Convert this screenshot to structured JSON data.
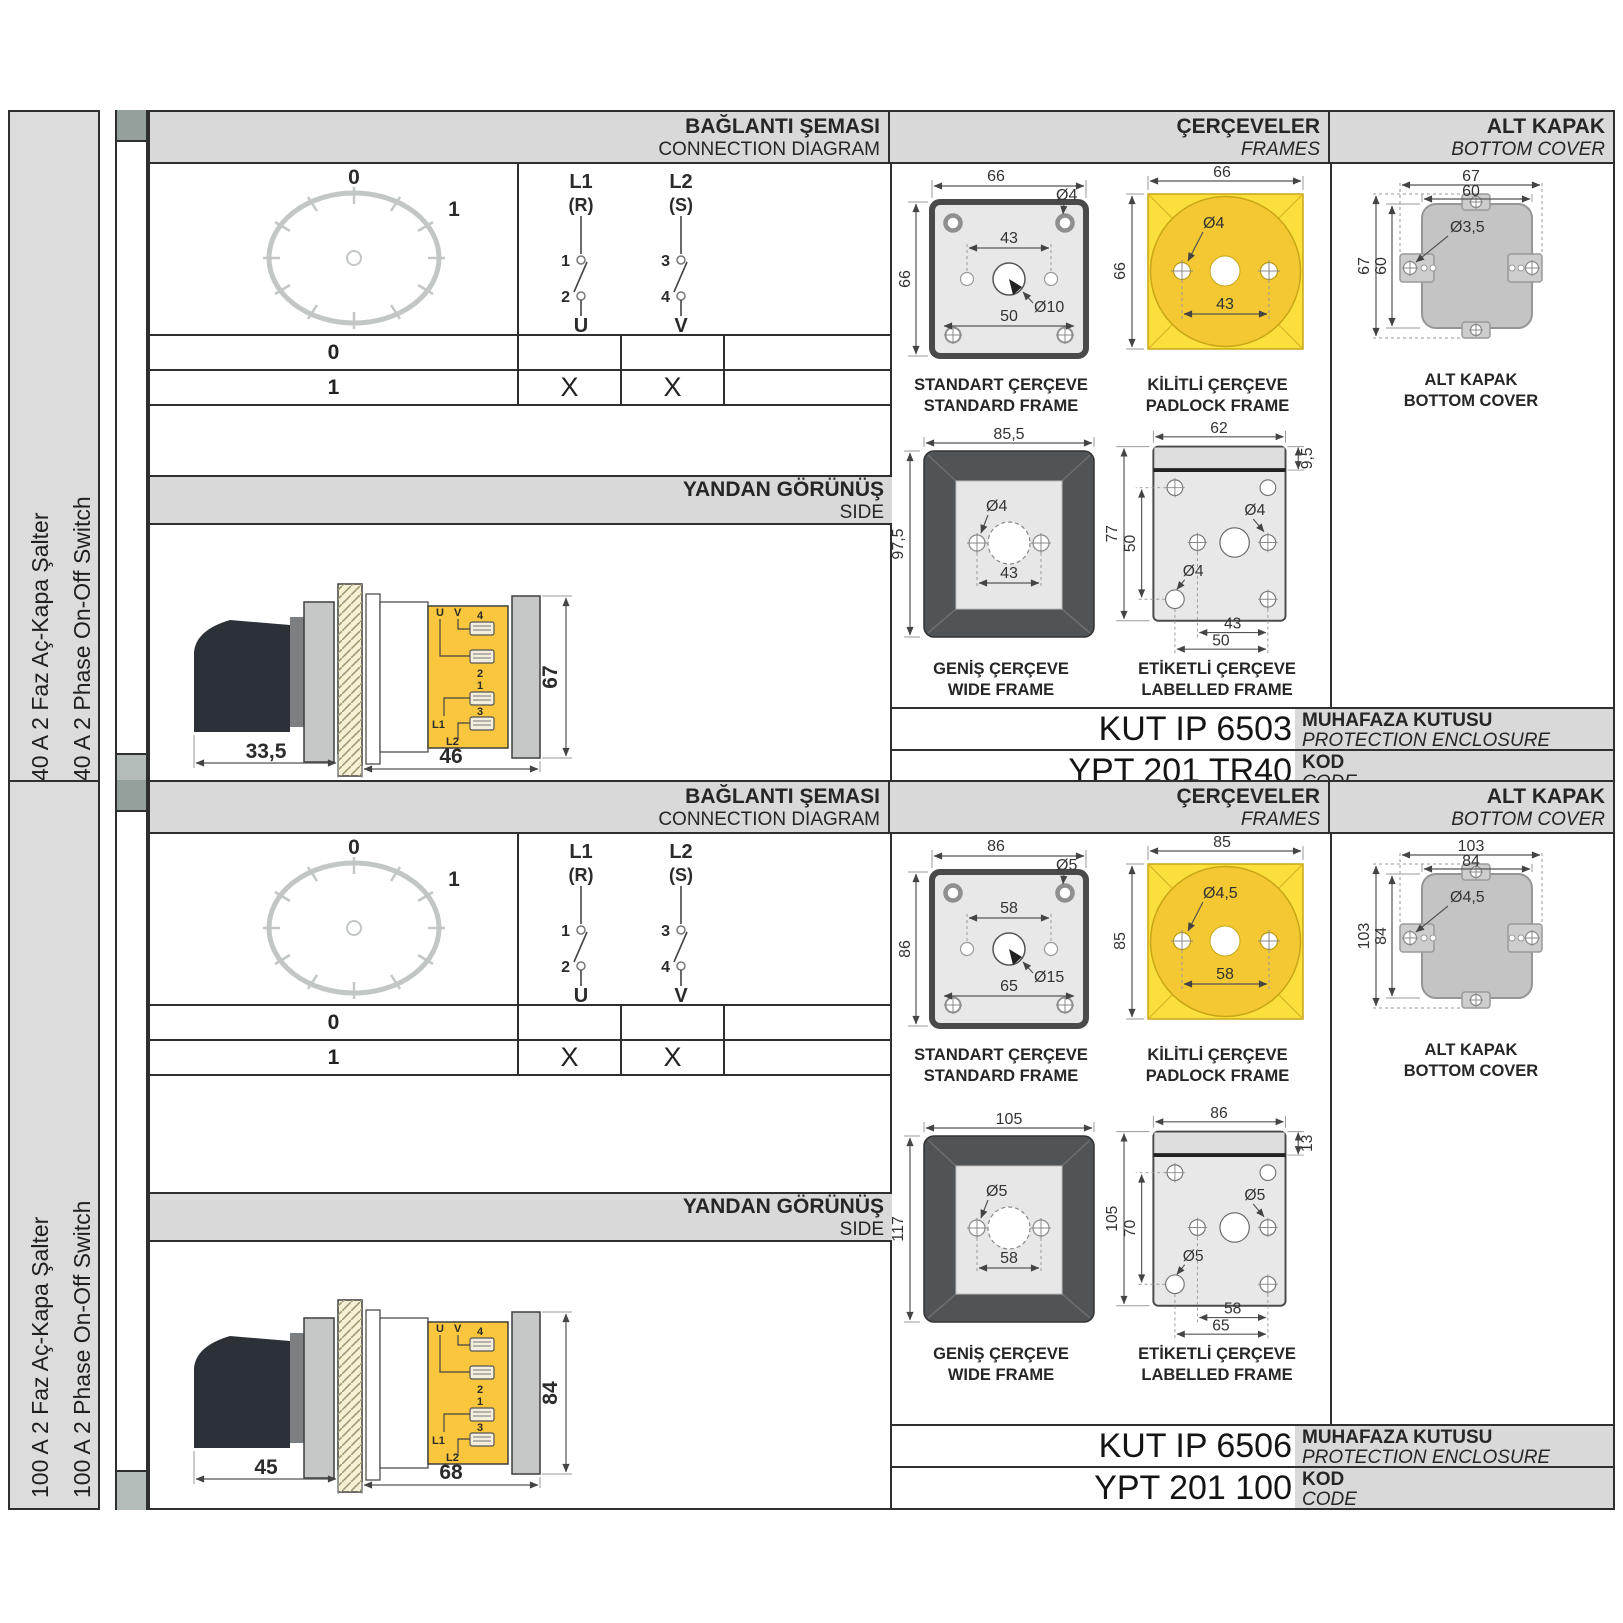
{
  "colors": {
    "header_gray": "#d9d9d9",
    "strip_gray": "#dcdcdc",
    "drawing_gray": "#e8e8e8",
    "dark_frame": "#515457",
    "padlock_yellow": "#fbdf3c",
    "padlock_gold": "#f3c832",
    "body_yellow": "#f9c63d",
    "cover_gray": "#c4c4c4"
  },
  "panels": [
    {
      "label_tr": "40 A 2 Faz Aç-Kapa Şalter",
      "label_en": "40 A 2 Phase On-Off Switch",
      "header": {
        "conn_tr": "BAĞLANTI ŞEMASI",
        "conn_en": "CONNECTION DIAGRAM",
        "frames_tr": "ÇERÇEVELER",
        "frames_en": "FRAMES",
        "cover_tr": "ALT KAPAK",
        "cover_en": "BOTTOM COVER"
      },
      "diagram": {
        "pos0": "0",
        "pos1": "1",
        "l1": "L1",
        "l1r": "(R)",
        "l2": "L2",
        "l2s": "(S)",
        "c1": "1",
        "c2": "2",
        "c3": "3",
        "c4": "4",
        "u": "U",
        "v": "V",
        "rows": [
          {
            "pos": "0",
            "u": "",
            "v": ""
          },
          {
            "pos": "1",
            "u": "X",
            "v": "X"
          }
        ]
      },
      "side": {
        "title_tr": "YANDAN GÖRÜNÜŞ",
        "title_en": "SIDE",
        "dim_handle": "33,5",
        "dim_body": "46",
        "dim_height": "67",
        "terminals": {
          "u": "U",
          "v": "V",
          "t4": "4",
          "t2": "2",
          "t1": "1",
          "t3": "3",
          "l1": "L1",
          "l2": "L2"
        }
      },
      "frames": {
        "standard": {
          "caption_tr": "STANDART ÇERÇEVE",
          "caption_en": "STANDARD FRAME",
          "width": "66",
          "height": "66",
          "hole": "Ø4",
          "inner": "43",
          "center": "Ø10",
          "lower": "50"
        },
        "padlock": {
          "caption_tr": "KİLİTLİ ÇERÇEVE",
          "caption_en": "PADLOCK FRAME",
          "width": "66",
          "height": "66",
          "hole": "Ø4",
          "inner": "43"
        },
        "wide": {
          "caption_tr": "GENİŞ ÇERÇEVE",
          "caption_en": "WIDE FRAME",
          "width": "85,5",
          "height": "97,5",
          "hole": "Ø4",
          "inner": "43"
        },
        "labelled": {
          "caption_tr": "ETİKETLİ ÇERÇEVE",
          "caption_en": "LABELLED FRAME",
          "width": "62",
          "strip": "9,5",
          "height": "77",
          "inner_v": "50",
          "hole1": "Ø4",
          "hole2": "Ø4",
          "inner_h": "43",
          "lower": "50"
        }
      },
      "cover": {
        "caption_tr": "ALT KAPAK",
        "caption_en": "BOTTOM COVER",
        "w_outer": "67",
        "w_inner": "60",
        "h_outer": "67",
        "h_inner": "60",
        "hole": "Ø3,5"
      },
      "codes": {
        "enclosure_code": "KUT IP 6503",
        "enclosure_tr": "MUHAFAZA KUTUSU",
        "enclosure_en": "PROTECTION ENCLOSURE",
        "code": "YPT 201 TR40",
        "code_tr": "KOD",
        "code_en": "CODE"
      }
    },
    {
      "label_tr": "100 A 2 Faz Aç-Kapa Şalter",
      "label_en": "100 A 2 Phase On-Off Switch",
      "header": {
        "conn_tr": "BAĞLANTI ŞEMASI",
        "conn_en": "CONNECTION DIAGRAM",
        "frames_tr": "ÇERÇEVELER",
        "frames_en": "FRAMES",
        "cover_tr": "ALT KAPAK",
        "cover_en": "BOTTOM COVER"
      },
      "diagram": {
        "pos0": "0",
        "pos1": "1",
        "l1": "L1",
        "l1r": "(R)",
        "l2": "L2",
        "l2s": "(S)",
        "c1": "1",
        "c2": "2",
        "c3": "3",
        "c4": "4",
        "u": "U",
        "v": "V",
        "rows": [
          {
            "pos": "0",
            "u": "",
            "v": ""
          },
          {
            "pos": "1",
            "u": "X",
            "v": "X"
          }
        ]
      },
      "side": {
        "title_tr": "YANDAN GÖRÜNÜŞ",
        "title_en": "SIDE",
        "dim_handle": "45",
        "dim_body": "68",
        "dim_height": "84",
        "terminals": {
          "u": "U",
          "v": "V",
          "t4": "4",
          "t2": "2",
          "t1": "1",
          "t3": "3",
          "l1": "L1",
          "l2": "L2"
        }
      },
      "frames": {
        "standard": {
          "caption_tr": "STANDART ÇERÇEVE",
          "caption_en": "STANDARD FRAME",
          "width": "86",
          "height": "86",
          "hole": "Ø5",
          "inner": "58",
          "center": "Ø15",
          "lower": "65"
        },
        "padlock": {
          "caption_tr": "KİLİTLİ ÇERÇEVE",
          "caption_en": "PADLOCK FRAME",
          "width": "85",
          "height": "85",
          "hole": "Ø4,5",
          "inner": "58"
        },
        "wide": {
          "caption_tr": "GENİŞ ÇERÇEVE",
          "caption_en": "WIDE FRAME",
          "width": "105",
          "height": "117",
          "hole": "Ø5",
          "inner": "58"
        },
        "labelled": {
          "caption_tr": "ETİKETLİ ÇERÇEVE",
          "caption_en": "LABELLED FRAME",
          "width": "86",
          "strip": "13",
          "height": "105",
          "inner_v": "70",
          "hole1": "Ø5",
          "hole2": "Ø5",
          "inner_h": "58",
          "lower": "65"
        }
      },
      "cover": {
        "caption_tr": "ALT KAPAK",
        "caption_en": "BOTTOM COVER",
        "w_outer": "103",
        "w_inner": "84",
        "h_outer": "103",
        "h_inner": "84",
        "hole": "Ø4,5"
      },
      "codes": {
        "enclosure_code": "KUT IP 6506",
        "enclosure_tr": "MUHAFAZA KUTUSU",
        "enclosure_en": "PROTECTION ENCLOSURE",
        "code": "YPT 201 100",
        "code_tr": "KOD",
        "code_en": "CODE"
      }
    }
  ]
}
